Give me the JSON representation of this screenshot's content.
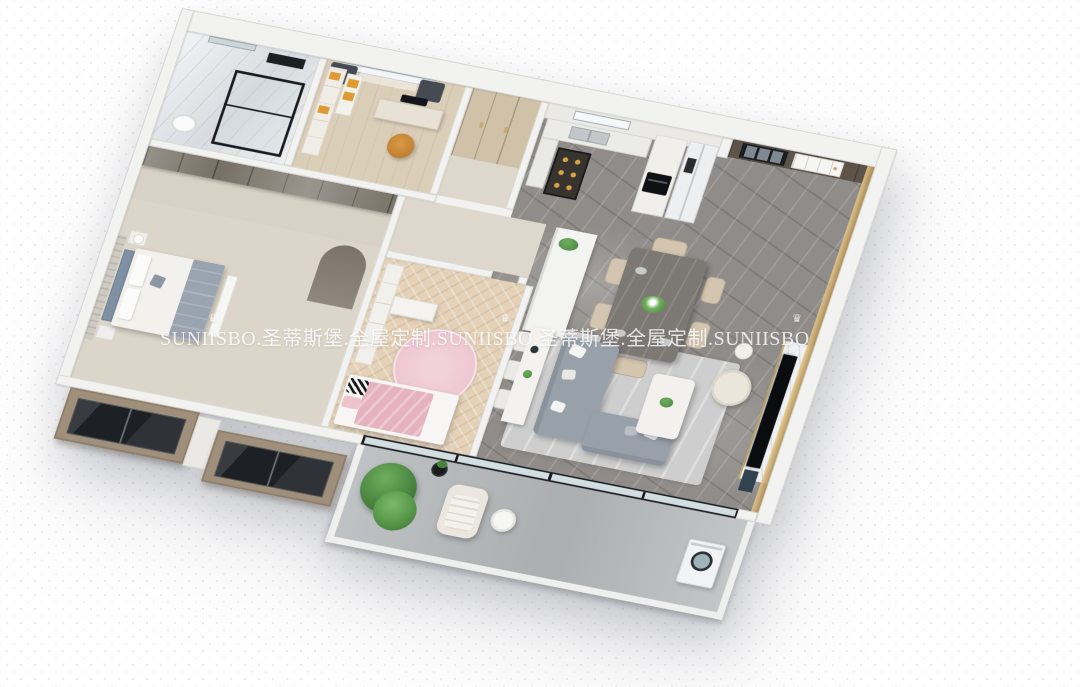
{
  "scene": {
    "type": "3d-apartment-floor-plan-render",
    "view": "isometric top-down cutaway of a three-bedroom apartment with balcony"
  },
  "watermark": {
    "text": "SUNIISBO.圣蒂斯堡.全屋定制.SUNIISBO.圣蒂斯堡.全屋定制.SUNIISBO",
    "brand": "SUNIISBO",
    "brand_cn": "圣蒂斯堡",
    "tagline_cn": "全屋定制",
    "crown_icon": "♛"
  },
  "palette": {
    "wall": "#f2f2f0",
    "wallEdge": "#d4d4d1",
    "marbleFloor": "#8f8c89",
    "livingRug": "#cdcecd",
    "studyFloor": "#dbceb8",
    "hallWood": "#cfc2a9",
    "herringboneFloor": "#e4d1b8",
    "masterFloor": "#dcd6ca",
    "corridorFloor": "#ded8cc",
    "balconyFloor": "#b6b9bb",
    "sofaGray": "#98a1aa",
    "bedBlue": "#8091a3",
    "duvetGray": "#9aa3b0",
    "linenWhite": "#f2f1ee",
    "pinkBlanket": "#e5b3bf",
    "pinkRug": "#efc9d3",
    "accentOrange": "#c08030",
    "shelfOrange": "#e09a33",
    "plantGreen": "#47823e",
    "plantLight": "#6fae5e",
    "goldTrim": "#c9a86b",
    "entryWood": "#5d5349",
    "wardrobeGlass": "#6e675c",
    "frameBlack": "#17191c",
    "fridgeWhite": "#edeff1",
    "counterWhite": "#ebebe8",
    "diningTable": "#7c7874",
    "chairBeige": "#d3c5af",
    "creamChair": "#eae6dc",
    "tvWallMarble": "#eef0f2",
    "tvBlack": "#0b0c0e",
    "glassBlue": "rgba(185,205,212,0.55)",
    "bayWood": "#a08f7a",
    "bayWindow": "#1d2125",
    "watermark": "rgba(255,255,255,0.82)"
  },
  "rooms": [
    {
      "id": "bathroom",
      "features": [
        "marble-walls",
        "glass-shower",
        "toilet",
        "window"
      ]
    },
    {
      "id": "study",
      "features": [
        "desk",
        "monitor",
        "orange-chair",
        "bookshelf",
        "dark-curtains",
        "window"
      ]
    },
    {
      "id": "hallway-closet",
      "features": [
        "wood-wardrobes"
      ]
    },
    {
      "id": "kitchen",
      "features": [
        "window-over-sink",
        "counter",
        "lit-display-cabinet",
        "built-in-oven",
        "double-door-fridge"
      ]
    },
    {
      "id": "entry",
      "features": [
        "dark-wood-panels",
        "white-panel-door",
        "black-frame-window",
        "gold-trim"
      ]
    },
    {
      "id": "master-bedroom",
      "features": [
        "walk-in-wardrobe",
        "blue-upholstered-bed",
        "nightstands",
        "foot-bench",
        "arch-niche",
        "striped-accent-wall"
      ]
    },
    {
      "id": "kids-bedroom",
      "features": [
        "herringbone-floor",
        "pink-bed",
        "round-pink-rug",
        "white-desk",
        "bookshelf"
      ]
    },
    {
      "id": "living-dining",
      "features": [
        "gray-marble-floor",
        "kitchen-island",
        "dining-table-six-chairs",
        "l-shaped-gray-sofa",
        "white-coffee-table",
        "area-rug",
        "console-table-with-chairs",
        "cream-accent-chair",
        "marble-tv-feature-wall"
      ]
    },
    {
      "id": "balcony",
      "features": [
        "green-plants",
        "lounge-chair",
        "round-side-table",
        "plant-stand",
        "washing-machine",
        "glass-sliding-doors"
      ]
    }
  ]
}
